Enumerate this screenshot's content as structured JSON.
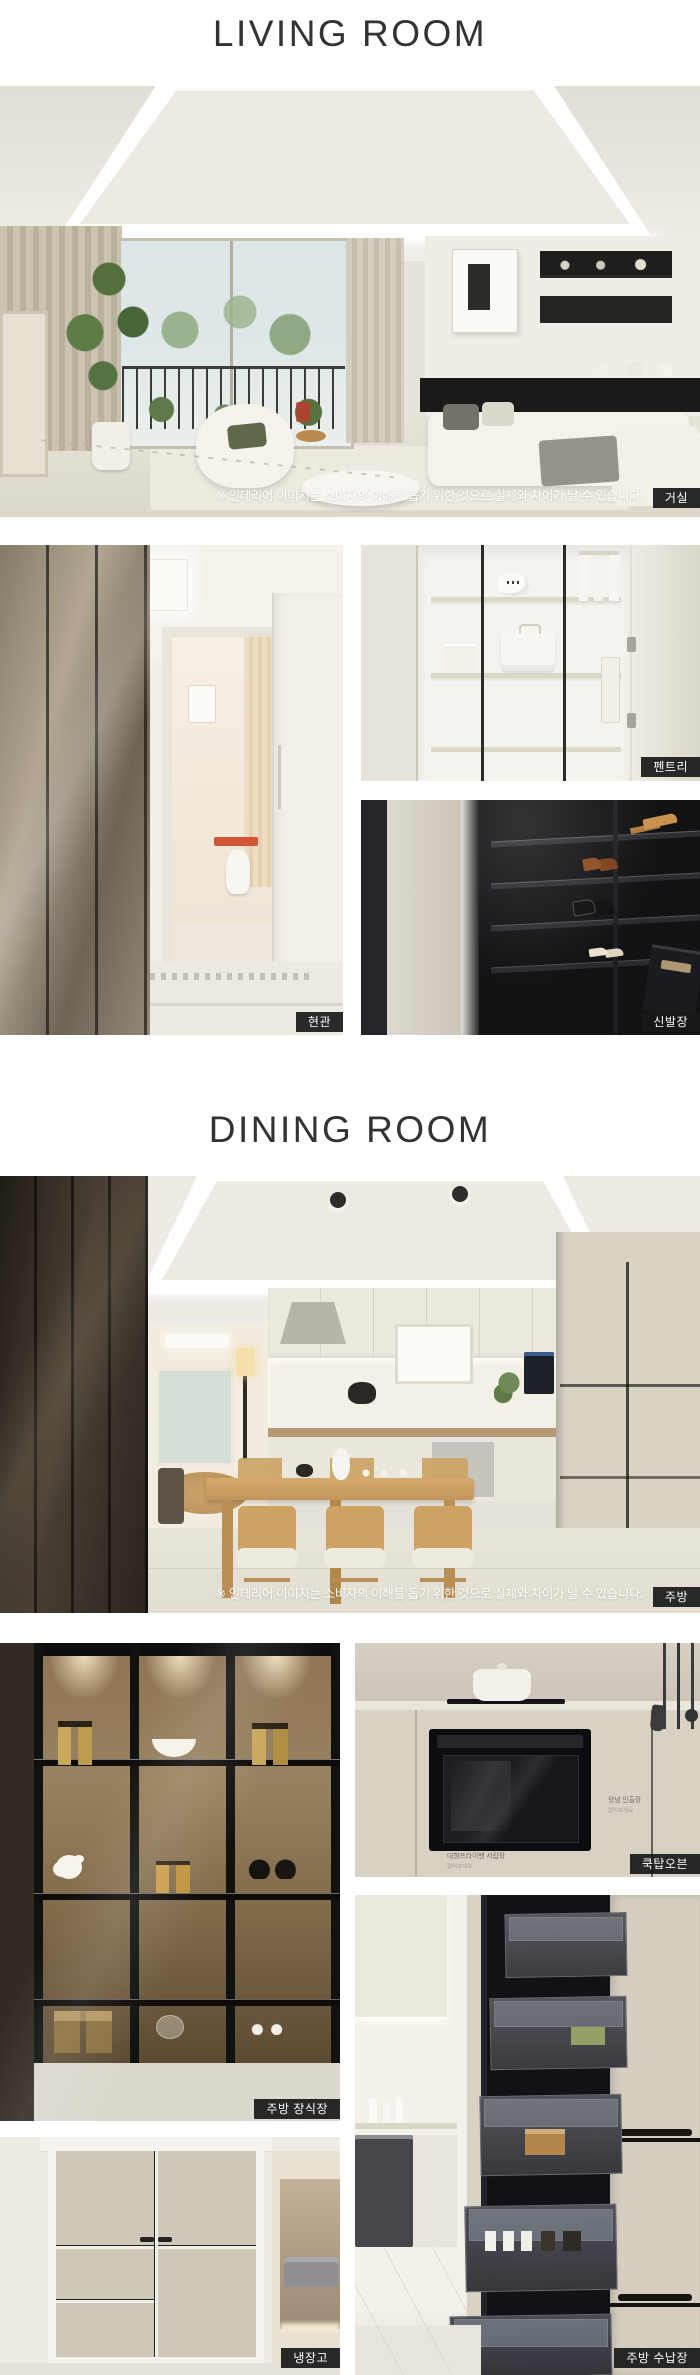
{
  "titles": {
    "living": "LIVING ROOM",
    "dining": "DINING ROOM"
  },
  "disclaimer": "※ 인테리어 이미지는 소비자의 이해를 돕기 위한 것으로 실제와 차이가 날 수 있습니다.",
  "photos": {
    "living_room": {
      "label": "거실"
    },
    "entrance": {
      "label": "현관"
    },
    "pantry": {
      "label": "펜트리"
    },
    "shoe_closet": {
      "label": "신발장"
    },
    "kitchen": {
      "label": "주방"
    },
    "kitchen_display": {
      "label": "주방 장식장"
    },
    "cooktop_oven": {
      "label": "쿡탑오븐",
      "annotations": {
        "right": {
          "title": "양념 인출장",
          "sub": "열어보세요"
        },
        "bottom": {
          "title": "대형프라이팬 서랍장",
          "sub": "열어보세요"
        }
      }
    },
    "refrigerator": {
      "label": "냉장고"
    },
    "kitchen_storage": {
      "label": "주방 수납장"
    }
  },
  "style": {
    "badge_bg": "#181818",
    "badge_text": "#ffffff",
    "title_color": "#333333",
    "page_bg": "#ffffff"
  }
}
